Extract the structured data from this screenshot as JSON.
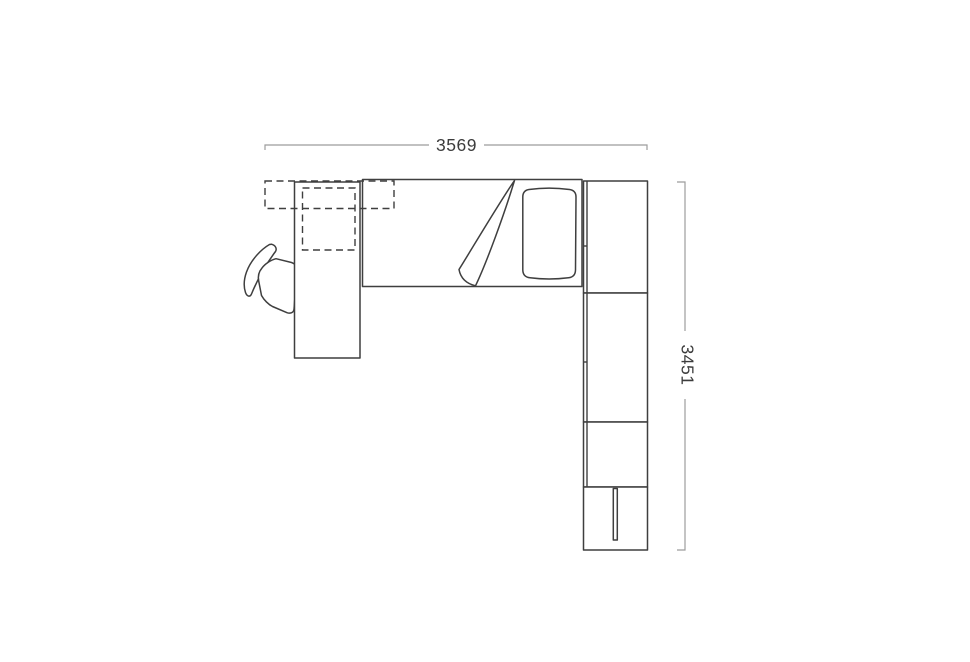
{
  "canvas": {
    "width": 970,
    "height": 662
  },
  "colors": {
    "background": "#ffffff",
    "outline": "#3f3f3f",
    "dimension-line": "#9c9c9c",
    "dimension-text": "#3c3c3c"
  },
  "diagram": {
    "kind": "furniture-floor-plan",
    "width_dimension": {
      "label": "3569"
    },
    "height_dimension": {
      "label": "3451"
    },
    "items": [
      "overhead-shelf-dashed",
      "overhead-cabinet-dashed",
      "desk",
      "desk-chair",
      "bed",
      "folded-blanket",
      "pillow",
      "wardrobe-section-1",
      "wardrobe-section-2",
      "wardrobe-section-3",
      "wardrobe-drawer-section",
      "drawer-handle"
    ]
  }
}
